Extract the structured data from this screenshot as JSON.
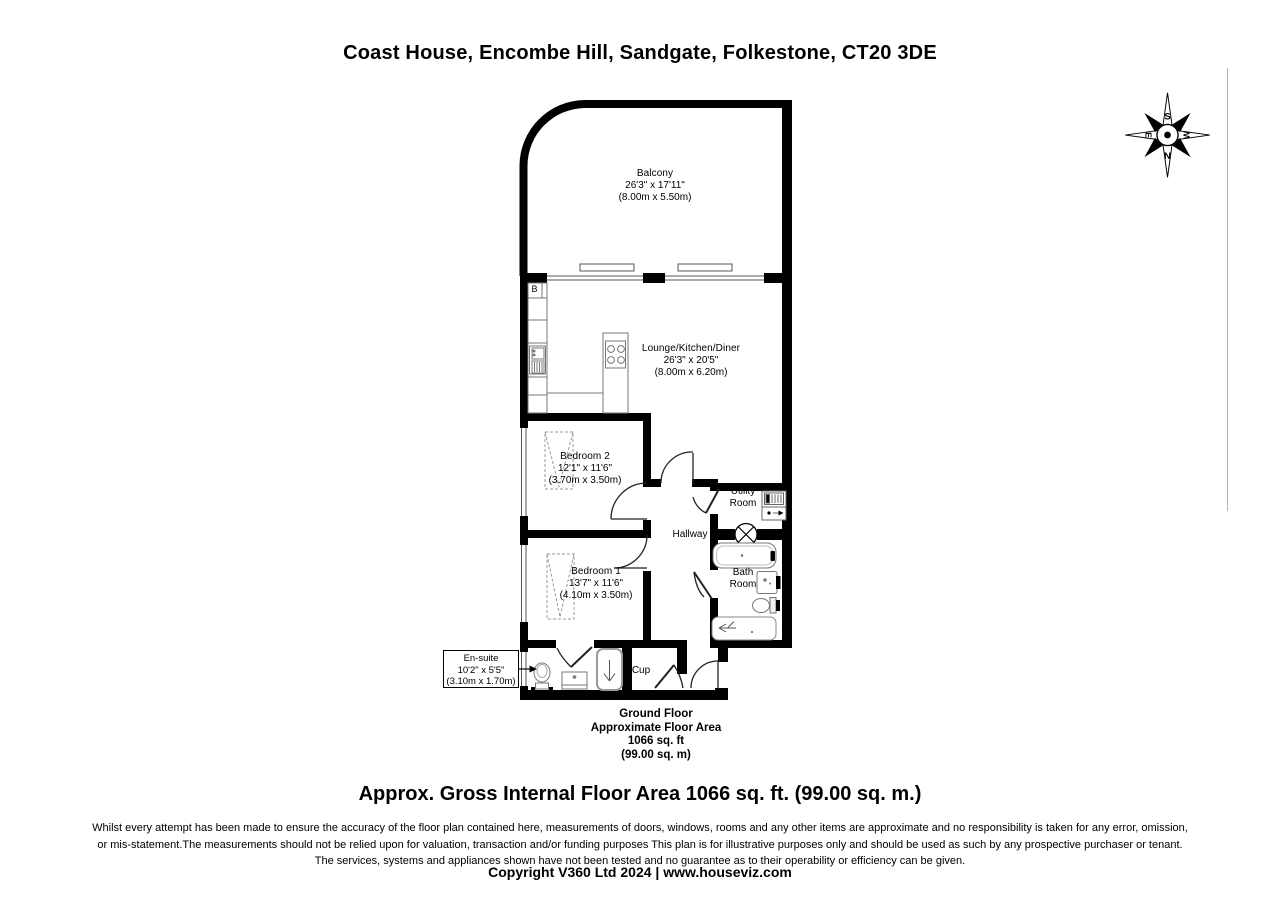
{
  "title": "Coast House, Encombe Hill, Sandgate, Folkestone, CT20 3DE",
  "compass": {
    "north": "N",
    "south": "S",
    "east": "E",
    "west": "W"
  },
  "rooms": {
    "balcony": {
      "name": "Balcony",
      "imperial": "26'3\" x 17'11\"",
      "metric": "(8.00m x 5.50m)"
    },
    "lounge": {
      "name": "Lounge/Kitchen/Diner",
      "imperial": "26'3\" x 20'5\"",
      "metric": "(8.00m x 6.20m)"
    },
    "bedroom2": {
      "name": "Bedroom 2",
      "imperial": "12'1\" x 11'6\"",
      "metric": "(3.70m x 3.50m)"
    },
    "bedroom1": {
      "name": "Bedroom 1",
      "imperial": "13'7\" x 11'6\"",
      "metric": "(4.10m x 3.50m)"
    },
    "ensuite": {
      "name": "En-suite",
      "imperial": "10'2\" x 5'5\"",
      "metric": "(3.10m x 1.70m)"
    },
    "utility": {
      "line1": "Utility",
      "line2": "Room"
    },
    "bathroom": {
      "line1": "Bath",
      "line2": "Room"
    },
    "hallway": {
      "name": "Hallway"
    },
    "cupboard": {
      "name": "Cup"
    },
    "boiler": {
      "label": "B"
    }
  },
  "floor_summary": {
    "line1": "Ground Floor",
    "line2": "Approximate Floor Area",
    "line3": "1066 sq. ft",
    "line4": "(99.00 sq. m)"
  },
  "area_line": "Approx. Gross Internal Floor Area 1066 sq. ft. (99.00 sq. m.)",
  "disclaimer": {
    "line1": "Whilst every attempt has been made to ensure the accuracy of the floor plan contained here, measurements of doors, windows, rooms and any other items are approximate and no responsibility is taken for any error, omission,",
    "line2": "or mis-statement.The measurements should not be relied upon for valuation, transaction and/or funding purposes This plan is for illustrative purposes only and should be used as such by any prospective purchaser or tenant.",
    "line3": "The services, systems and appliances shown have not been tested and no guarantee as to their operability or efficiency can be given."
  },
  "copyright": "Copyright V360 Ltd 2024 | www.houseviz.com",
  "colors": {
    "wall": "#000000",
    "fixture_stroke": "#777777",
    "window_line": "#555555",
    "background": "#ffffff",
    "page_border": "#b5b5b5"
  }
}
